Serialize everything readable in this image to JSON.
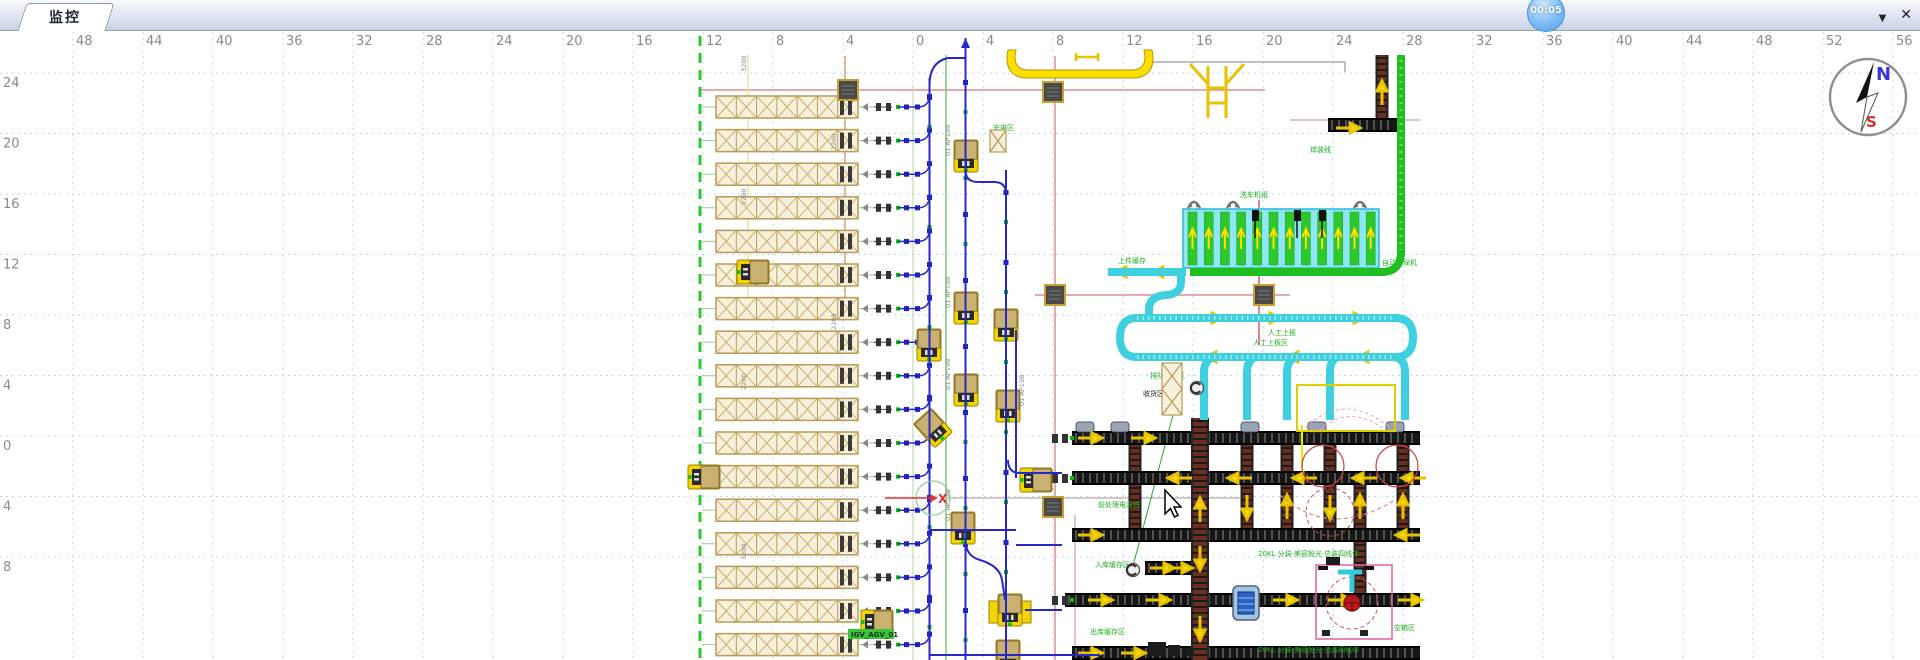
{
  "window": {
    "tab_label": "监控",
    "timer_badge": "00:05",
    "dropdown_icon": "▼",
    "close_icon": "✕"
  },
  "compass": {
    "north_label": "N",
    "south_label": "S"
  },
  "cursor": {
    "x": 1165,
    "y": 490
  },
  "colors": {
    "accent_blue": "#2828c8",
    "rack_tan": "#c9b172",
    "rack_fill": "#f7f0dc",
    "agv_yellow": "#f2d400",
    "conveyor_cyan": "#3fd0e0",
    "belt_green": "#1fbf1f",
    "grid_blue": "#bcd9ec",
    "ruler_gray": "#8a8a8a",
    "pink": "#d89090",
    "red": "#d03030",
    "arrow_yellow": "#ffe000"
  },
  "rulers": {
    "top_values": [
      "48",
      "44",
      "40",
      "36",
      "32",
      "28",
      "24",
      "20",
      "16",
      "12",
      "8",
      "4",
      "0",
      "4",
      "8",
      "12",
      "16",
      "20",
      "24",
      "28",
      "32",
      "36",
      "40",
      "44",
      "48",
      "52",
      "56"
    ],
    "top_start_x": 73,
    "top_spacing": 70,
    "left_values": [
      "24",
      "20",
      "16",
      "12",
      "8",
      "4",
      "0",
      "4",
      "8"
    ],
    "left_start_y": 73,
    "left_spacing": 60.5
  },
  "diagram": {
    "racks": {
      "x": 716,
      "width": 142,
      "top": 96,
      "pitch": 33.6,
      "count": 17,
      "height": 22,
      "cells": 7,
      "trunk_x": 929.5
    },
    "agvs": [
      {
        "x": 966,
        "y": 156,
        "r": 0,
        "t": "v"
      },
      {
        "x": 753,
        "y": 272,
        "r": 90,
        "t": "v"
      },
      {
        "x": 966,
        "y": 308,
        "r": 0,
        "t": "v"
      },
      {
        "x": 1006,
        "y": 325,
        "r": 0,
        "t": "v"
      },
      {
        "x": 929,
        "y": 345,
        "r": 0,
        "t": "v"
      },
      {
        "x": 966,
        "y": 390,
        "r": 0,
        "t": "v"
      },
      {
        "x": 1008,
        "y": 406,
        "r": 0,
        "t": "v"
      },
      {
        "x": 933,
        "y": 428,
        "r": -42,
        "t": "v"
      },
      {
        "x": 704,
        "y": 477,
        "r": 90,
        "t": "v"
      },
      {
        "x": 1036,
        "y": 480,
        "r": 90,
        "t": "v"
      },
      {
        "x": 963,
        "y": 528,
        "r": 0,
        "t": "v"
      },
      {
        "x": 877,
        "y": 622,
        "r": 90,
        "t": "v"
      },
      {
        "x": 1010,
        "y": 610,
        "r": 0,
        "t": "big"
      },
      {
        "x": 1008,
        "y": 656,
        "r": 0,
        "t": "v"
      }
    ],
    "stations": [
      [
        848,
        90
      ],
      [
        1053,
        92
      ],
      [
        1055,
        295
      ],
      [
        1264,
        295
      ],
      [
        1053,
        507
      ]
    ],
    "labels": [
      {
        "t": "洗车机组",
        "x": 1240,
        "y": 197,
        "c": "g"
      },
      {
        "t": "上件缓存",
        "x": 1118,
        "y": 263,
        "c": "g"
      },
      {
        "t": "自动拆垛机",
        "x": 1382,
        "y": 265,
        "c": "g"
      },
      {
        "t": "排队缓存区",
        "x": 1150,
        "y": 378,
        "c": "g"
      },
      {
        "t": "收货区",
        "x": 1143,
        "y": 396,
        "c": "k"
      },
      {
        "t": "人工上板区",
        "x": 1253,
        "y": 345,
        "c": "g"
      },
      {
        "t": "前处理电泳线",
        "x": 1098,
        "y": 507,
        "c": "g"
      },
      {
        "t": "焊装线",
        "x": 1310,
        "y": 152,
        "c": "g"
      },
      {
        "t": "20KL 分装·美容抛光·总装四线体",
        "x": 1258,
        "y": 556,
        "c": "g"
      },
      {
        "t": "20KL 分装·美容抛光·总装四线体",
        "x": 1258,
        "y": 652,
        "c": "g"
      },
      {
        "t": "入库缓存区",
        "x": 1095,
        "y": 567,
        "c": "g"
      },
      {
        "t": "出库缓存区",
        "x": 1090,
        "y": 634,
        "c": "g"
      },
      {
        "t": "空箱区",
        "x": 1394,
        "y": 630,
        "c": "g"
      },
      {
        "t": "充电区",
        "x": 993,
        "y": 130,
        "c": "g"
      },
      {
        "t": "人工上板",
        "x": 1268,
        "y": 335,
        "c": "g"
      }
    ],
    "vlabels": [
      {
        "t": "01 AP19B",
        "x": 950,
        "y": 156
      },
      {
        "t": "01 AP19B",
        "x": 950,
        "y": 308
      },
      {
        "t": "01 AP19B",
        "x": 950,
        "y": 390
      },
      {
        "t": "01 AP19B",
        "x": 1024,
        "y": 406
      },
      {
        "t": "01 AP19B",
        "x": 950,
        "y": 521
      },
      {
        "t": "3200",
        "x": 746,
        "y": 72
      },
      {
        "t": "2200",
        "x": 746,
        "y": 205
      },
      {
        "t": "2200",
        "x": 746,
        "y": 390
      },
      {
        "t": "3200",
        "x": 746,
        "y": 560
      },
      {
        "t": "2200",
        "x": 836,
        "y": 150
      },
      {
        "t": "2200",
        "x": 836,
        "y": 330
      }
    ],
    "agv_tag": {
      "t": "IGV_AGV_01",
      "x": 851,
      "y": 636
    },
    "pink_lines": [
      {
        "x1": 700,
        "y1": 90,
        "x2": 1265,
        "y2": 90,
        "c": "#d89090"
      },
      {
        "x1": 1290,
        "y1": 120,
        "x2": 1420,
        "y2": 120,
        "c": "#e0b0b0"
      },
      {
        "x1": 1035,
        "y1": 295,
        "x2": 1290,
        "y2": 295,
        "c": "#d89090"
      },
      {
        "x1": 845,
        "y1": 56,
        "x2": 845,
        "y2": 300,
        "c": "#d8a080"
      },
      {
        "x1": 1055,
        "y1": 56,
        "x2": 1055,
        "y2": 660,
        "c": "#d89090"
      },
      {
        "x1": 1259,
        "y1": 200,
        "x2": 1259,
        "y2": 345,
        "c": "#d06060"
      },
      {
        "x1": 1075,
        "y1": 515,
        "x2": 1075,
        "y2": 660,
        "c": "#e0b0b0"
      },
      {
        "x1": 748,
        "y1": 55,
        "x2": 748,
        "y2": 300,
        "c": "#ece0a8"
      },
      {
        "x1": 948,
        "y1": 498,
        "x2": 1240,
        "y2": 498,
        "c": "#c6b6b6"
      },
      {
        "x1": 1150,
        "y1": 62,
        "x2": 1345,
        "y2": 62,
        "c": "#aaaaaa"
      },
      {
        "x1": 1345,
        "y1": 62,
        "x2": 1345,
        "y2": 72,
        "c": "#aaaaaa"
      }
    ],
    "green_lines": [
      {
        "x1": 700,
        "y1": 36,
        "x2": 700,
        "y2": 660,
        "w": 3,
        "d": "10 7",
        "c": "#2ec82e"
      },
      {
        "x1": 913,
        "y1": 85,
        "x2": 913,
        "y2": 660,
        "w": 1,
        "d": "",
        "c": "#b2d8a8"
      },
      {
        "x1": 946,
        "y1": 55,
        "x2": 946,
        "y2": 660,
        "w": 1.5,
        "d": "",
        "c": "#7cc87c"
      },
      {
        "x1": 1173,
        "y1": 415,
        "x2": 1133,
        "y2": 566,
        "w": 1,
        "d": "",
        "c": "#2ea82e"
      }
    ],
    "conv_rows": [
      {
        "x1": 1072,
        "x2": 1420,
        "y": 431
      },
      {
        "x1": 1072,
        "x2": 1420,
        "y": 471
      },
      {
        "x1": 1072,
        "x2": 1420,
        "y": 528
      },
      {
        "x1": 1065,
        "x2": 1420,
        "y": 593
      },
      {
        "x1": 1145,
        "x2": 1192,
        "y": 561
      },
      {
        "x1": 1072,
        "x2": 1420,
        "y": 646
      },
      {
        "x1": 1328,
        "x2": 1397,
        "y": 118
      }
    ],
    "conv_verticals": [
      {
        "x": 1135,
        "y1": 445,
        "y2": 471
      },
      {
        "x": 1135,
        "y1": 485,
        "y2": 528
      },
      {
        "x": 1200,
        "y1": 418,
        "y2": 660,
        "w": 18
      },
      {
        "x": 1247,
        "y1": 445,
        "y2": 471
      },
      {
        "x": 1247,
        "y1": 485,
        "y2": 528
      },
      {
        "x": 1287,
        "y1": 445,
        "y2": 471
      },
      {
        "x": 1287,
        "y1": 485,
        "y2": 528
      },
      {
        "x": 1330,
        "y1": 445,
        "y2": 471
      },
      {
        "x": 1330,
        "y1": 485,
        "y2": 528
      },
      {
        "x": 1360,
        "y1": 485,
        "y2": 528
      },
      {
        "x": 1360,
        "y1": 542,
        "y2": 593
      },
      {
        "x": 1403,
        "y1": 445,
        "y2": 471
      },
      {
        "x": 1403,
        "y1": 485,
        "y2": 528
      },
      {
        "x": 1382,
        "y1": 55,
        "y2": 118
      }
    ],
    "arrows": [
      [
        1090,
        438,
        "r"
      ],
      [
        1143,
        438,
        "r"
      ],
      [
        1180,
        478,
        "l"
      ],
      [
        1240,
        478,
        "l"
      ],
      [
        1305,
        478,
        "l"
      ],
      [
        1365,
        478,
        "l"
      ],
      [
        1414,
        478,
        "l"
      ],
      [
        1090,
        535,
        "r"
      ],
      [
        1408,
        535,
        "l"
      ],
      [
        1100,
        600,
        "r"
      ],
      [
        1158,
        600,
        "r"
      ],
      [
        1285,
        600,
        "r"
      ],
      [
        1340,
        600,
        "r"
      ],
      [
        1410,
        600,
        "r"
      ],
      [
        1162,
        568,
        "r"
      ],
      [
        1180,
        568,
        "r"
      ],
      [
        1090,
        653,
        "r"
      ],
      [
        1133,
        653,
        "r"
      ],
      [
        1200,
        510,
        "u"
      ],
      [
        1247,
        507,
        "d"
      ],
      [
        1287,
        507,
        "u"
      ],
      [
        1330,
        507,
        "d"
      ],
      [
        1360,
        507,
        "u"
      ],
      [
        1403,
        507,
        "u"
      ],
      [
        1200,
        558,
        "d"
      ],
      [
        1200,
        628,
        "d"
      ],
      [
        1382,
        93,
        "u"
      ],
      [
        1348,
        128,
        "r"
      ],
      [
        1165,
        272,
        "l"
      ],
      [
        1128,
        272,
        "l"
      ],
      [
        1210,
        318,
        "r"
      ],
      [
        1268,
        318,
        "r"
      ],
      [
        1352,
        318,
        "r"
      ],
      [
        1218,
        357,
        "l"
      ],
      [
        1300,
        357,
        "l"
      ],
      [
        1370,
        357,
        "l"
      ]
    ],
    "bank": {
      "x": 1183,
      "y": 209,
      "w": 196,
      "h": 59,
      "lanes": 12,
      "lane_pitch": 16.2,
      "lane_w": 9
    },
    "clamps": [
      1194,
      1233,
      1360
    ],
    "hooks": [
      1255,
      1297,
      1322
    ],
    "equipment_x": [
      1085,
      1120,
      1250,
      1317,
      1395
    ],
    "dumbbell_rows": [
      431,
      471,
      593
    ]
  }
}
